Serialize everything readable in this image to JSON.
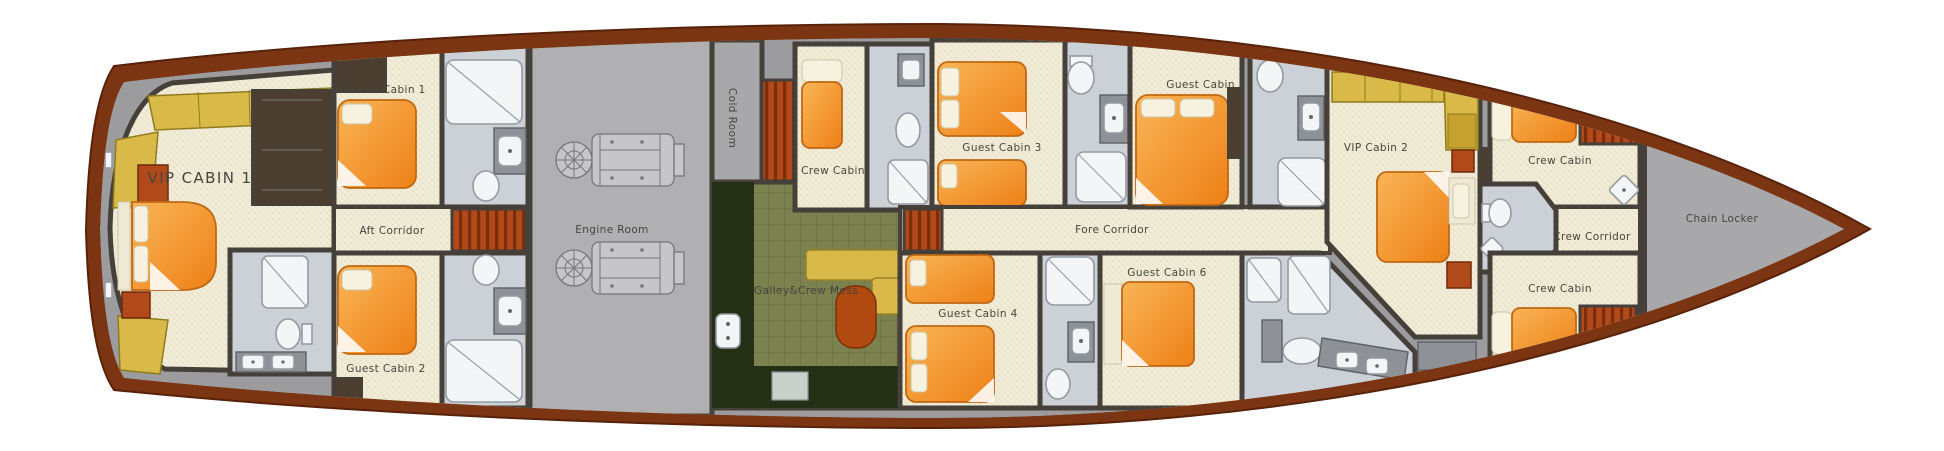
{
  "plan": {
    "type": "yacht-lower-deck-floor-plan"
  },
  "rooms": {
    "vip_cabin_1": {
      "label": "VIP CABIN 1"
    },
    "guest_cabin_1": {
      "label": "Guest Cabin 1"
    },
    "guest_cabin_2": {
      "label": "Guest Cabin 2"
    },
    "aft_corridor": {
      "label": "Aft Corridor"
    },
    "engine_room": {
      "label": "Engine Room"
    },
    "cold_room": {
      "label": "Cold Room"
    },
    "crew_cabin_mid": {
      "label": "Crew Cabin"
    },
    "galley_crew_mess": {
      "label": "Galley&Crew Mess"
    },
    "guest_cabin_3": {
      "label": "Guest Cabin 3"
    },
    "guest_cabin_4": {
      "label": "Guest Cabin 4"
    },
    "fore_corridor": {
      "label": "Fore Corridor"
    },
    "guest_cabin_5": {
      "label": "Guest Cabin 5"
    },
    "guest_cabin_6": {
      "label": "Guest Cabin 6"
    },
    "vip_cabin_2": {
      "label": "VIP Cabin 2"
    },
    "crew_cabin_fwd_port": {
      "label": "Crew Cabin"
    },
    "crew_corridor": {
      "label": "Crew Corridor"
    },
    "crew_cabin_fwd_starboard": {
      "label": "Crew Cabin"
    },
    "chain_locker": {
      "label": "Chain Locker"
    }
  },
  "palette": {
    "hull": "#7b3513",
    "hull_edge": "#58220a",
    "deck": "#9c9c9e",
    "deck_inner": "#a8a8aa",
    "engine_floor": "#b0b0b2",
    "floor_cream": "#f2edd9",
    "wall": "#46403a",
    "bed_orange": "#f49b33",
    "sofa_yellow": "#d9ba48",
    "sofa_yellow_dark": "#c7a12e",
    "stair_rust": "#b04a1a",
    "galley_olive": "#7c8150",
    "galley_dark": "#243015",
    "counter_yellow": "#d9b94a",
    "table_rust": "#b04a10",
    "bath_floor": "#ccd1d7",
    "fixture_white": "#f3f5f6",
    "fixture_gray": "#8e9297",
    "text": "#45453e"
  }
}
